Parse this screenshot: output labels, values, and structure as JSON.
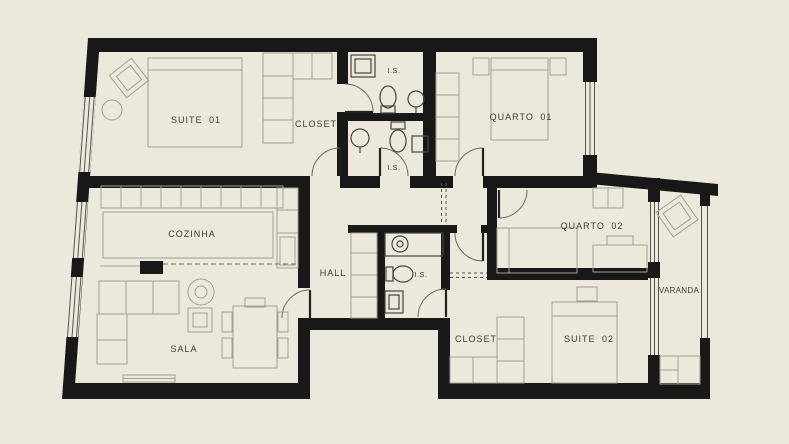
{
  "colors": {
    "background": "#ece9dc",
    "wall": "#181818",
    "furniture_line": "#a39e90",
    "fixture_line": "#45433c",
    "label_text": "#3c3a33"
  },
  "rooms": {
    "suite01": {
      "label": "SUITE 01"
    },
    "closet_top": {
      "label": "CLOSET"
    },
    "is1": {
      "label": "I.S."
    },
    "is2": {
      "label": "I.S."
    },
    "quarto01": {
      "label": "QUARTO 01"
    },
    "cozinha": {
      "label": "COZINHA"
    },
    "hall": {
      "label": "HALL"
    },
    "is_central": {
      "label": "I.S."
    },
    "quarto02": {
      "label": "QUARTO 02"
    },
    "varanda": {
      "label": "VARANDA"
    },
    "sala": {
      "label": "SALA"
    },
    "closet_bottom": {
      "label": "CLOSET"
    },
    "suite02": {
      "label": "SUITE 02"
    }
  }
}
